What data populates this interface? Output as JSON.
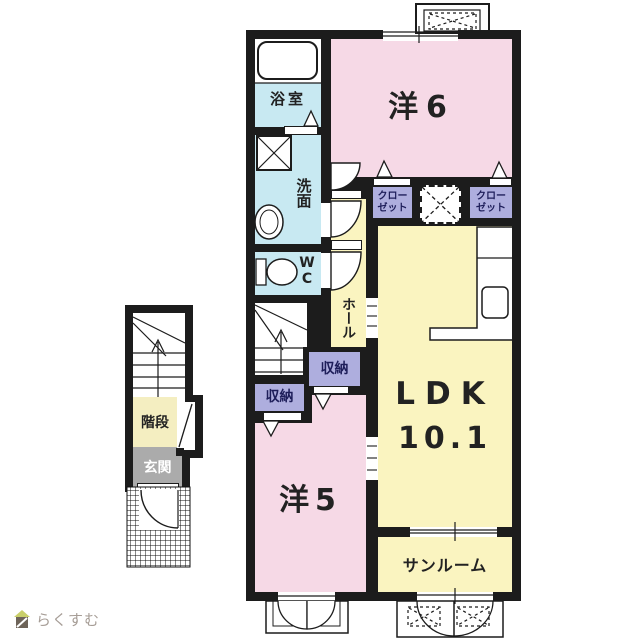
{
  "labels": {
    "yo6": "洋6",
    "closet_left": "クローゼット",
    "closet_right": "クローゼット",
    "bath": "浴室",
    "wash": "洗面",
    "wc": "WC",
    "hall": "ホール",
    "storage_hall": "収納",
    "storage_yo5": "収納",
    "ldk": "LDK",
    "ldk_size": "10.1",
    "yo5": "洋5",
    "sunroom": "サンルーム",
    "stairs": "階段",
    "entrance": "玄関"
  },
  "logo": {
    "text": "らくすむ"
  },
  "colors": {
    "wall": "#1c1c1c",
    "room-pink": "#f6d9e6",
    "room-yellow": "#faf4c0",
    "room-blue": "#c8e9f2",
    "closet-purple": "#aeaede",
    "entrance-gray": "#ababab",
    "stairs-yellow": "#f4eec1",
    "logo-text": "#a69d96",
    "logo-roof": "#c9cf6a",
    "logo-body": "#6e6459"
  }
}
